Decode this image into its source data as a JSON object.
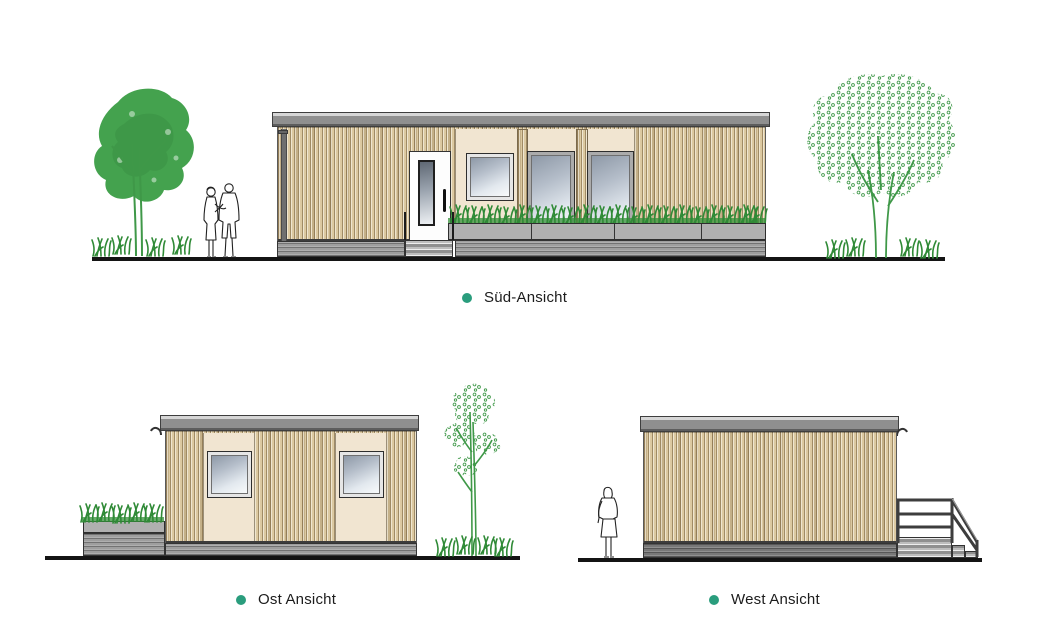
{
  "sheet": {
    "background": "#ffffff"
  },
  "views": {
    "sued": {
      "label": "Süd-Ansicht"
    },
    "ost": {
      "label": "Ost Ansicht"
    },
    "west": {
      "label": "West Ansicht"
    }
  },
  "colors": {
    "dot": "#2a9d7d",
    "ground": "#141414",
    "roof": "#8f8f8f",
    "roof-top": "#d6d6d6",
    "wood": "#dcc9a1",
    "panel": "#f1e5d1",
    "plinth": "#9e9e9e",
    "planter": "#b0b0b0",
    "plant": "#2f8a36",
    "tree": "#3f9848",
    "canopy": "#44a24e",
    "glass-dark": "#8e99a7",
    "glass-light": "#f8fafb",
    "door": "#fdfdfd",
    "outline": "#2e2e2e"
  }
}
